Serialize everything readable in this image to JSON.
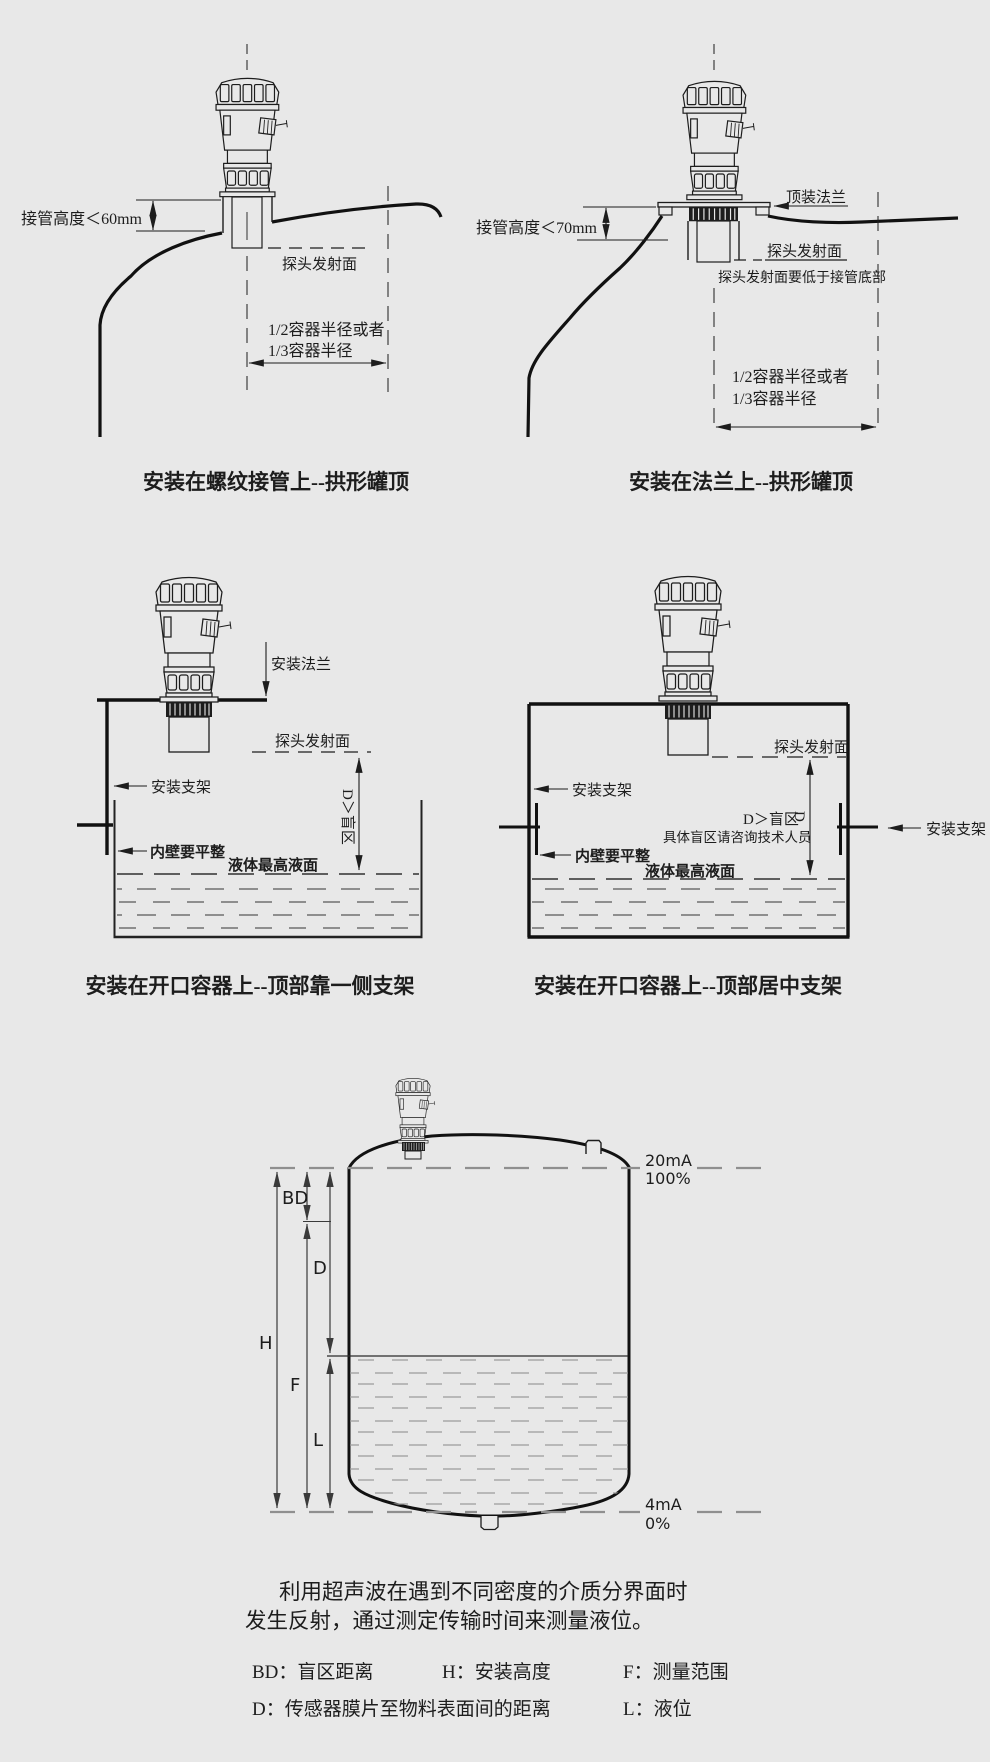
{
  "colors": {
    "background": "#e8e8e8",
    "ink": "#1d1d1d",
    "dim_line": "#3a3a3a",
    "liquid_dash": "#6f6f6f",
    "level_dash": "#8f8f8f"
  },
  "diagrams": {
    "threaded_dome": {
      "caption": "安装在螺纹接管上--拱形罐顶",
      "labels": {
        "pipe_height": "接管高度＜60mm",
        "probe_face": "探头发射面",
        "radius_line1": "1/2容器半径或者",
        "radius_line2": "1/3容器半径"
      }
    },
    "flange_dome": {
      "caption": "安装在法兰上--拱形罐顶",
      "labels": {
        "top_flange": "顶装法兰",
        "pipe_height": "接管高度＜70mm",
        "probe_face": "探头发射面",
        "probe_below_pipe": "探头发射面要低于接管底部",
        "radius_line1": "1/2容器半径或者",
        "radius_line2": "1/3容器半径"
      }
    },
    "open_side_bracket": {
      "caption": "安装在开口容器上--顶部靠一侧支架",
      "labels": {
        "mount_flange": "安装法兰",
        "probe_face": "探头发射面",
        "bracket": "安装支架",
        "blind_zone": "D＞盲区",
        "inner_wall": "内壁要平整",
        "max_level": "液体最高液面"
      }
    },
    "open_center_bracket": {
      "caption": "安装在开口容器上--顶部居中支架",
      "labels": {
        "probe_face": "探头发射面",
        "bracket_left": "安装支架",
        "bracket_right": "安装支架",
        "blind_zone": "D＞盲区",
        "blind_d": "D",
        "consult": "具体盲区请咨询技术人员",
        "inner_wall": "内壁要平整",
        "max_level": "液体最高液面"
      }
    },
    "measurement": {
      "labels": {
        "ma20": "20mA",
        "pct100": "100%",
        "ma4": "4mA",
        "pct0": "0%",
        "bd": "BD",
        "d": "D",
        "h": "H",
        "f": "F",
        "l": "L"
      }
    }
  },
  "description": {
    "line1": "利用超声波在遇到不同密度的介质分界面时",
    "line2": "发生反射，通过测定传输时间来测量液位。"
  },
  "legend": {
    "bd": "BD：盲区距离",
    "h": "H：安装高度",
    "f": "F：测量范围",
    "d": "D：传感器膜片至物料表面间的距离",
    "l": "L：液位"
  }
}
